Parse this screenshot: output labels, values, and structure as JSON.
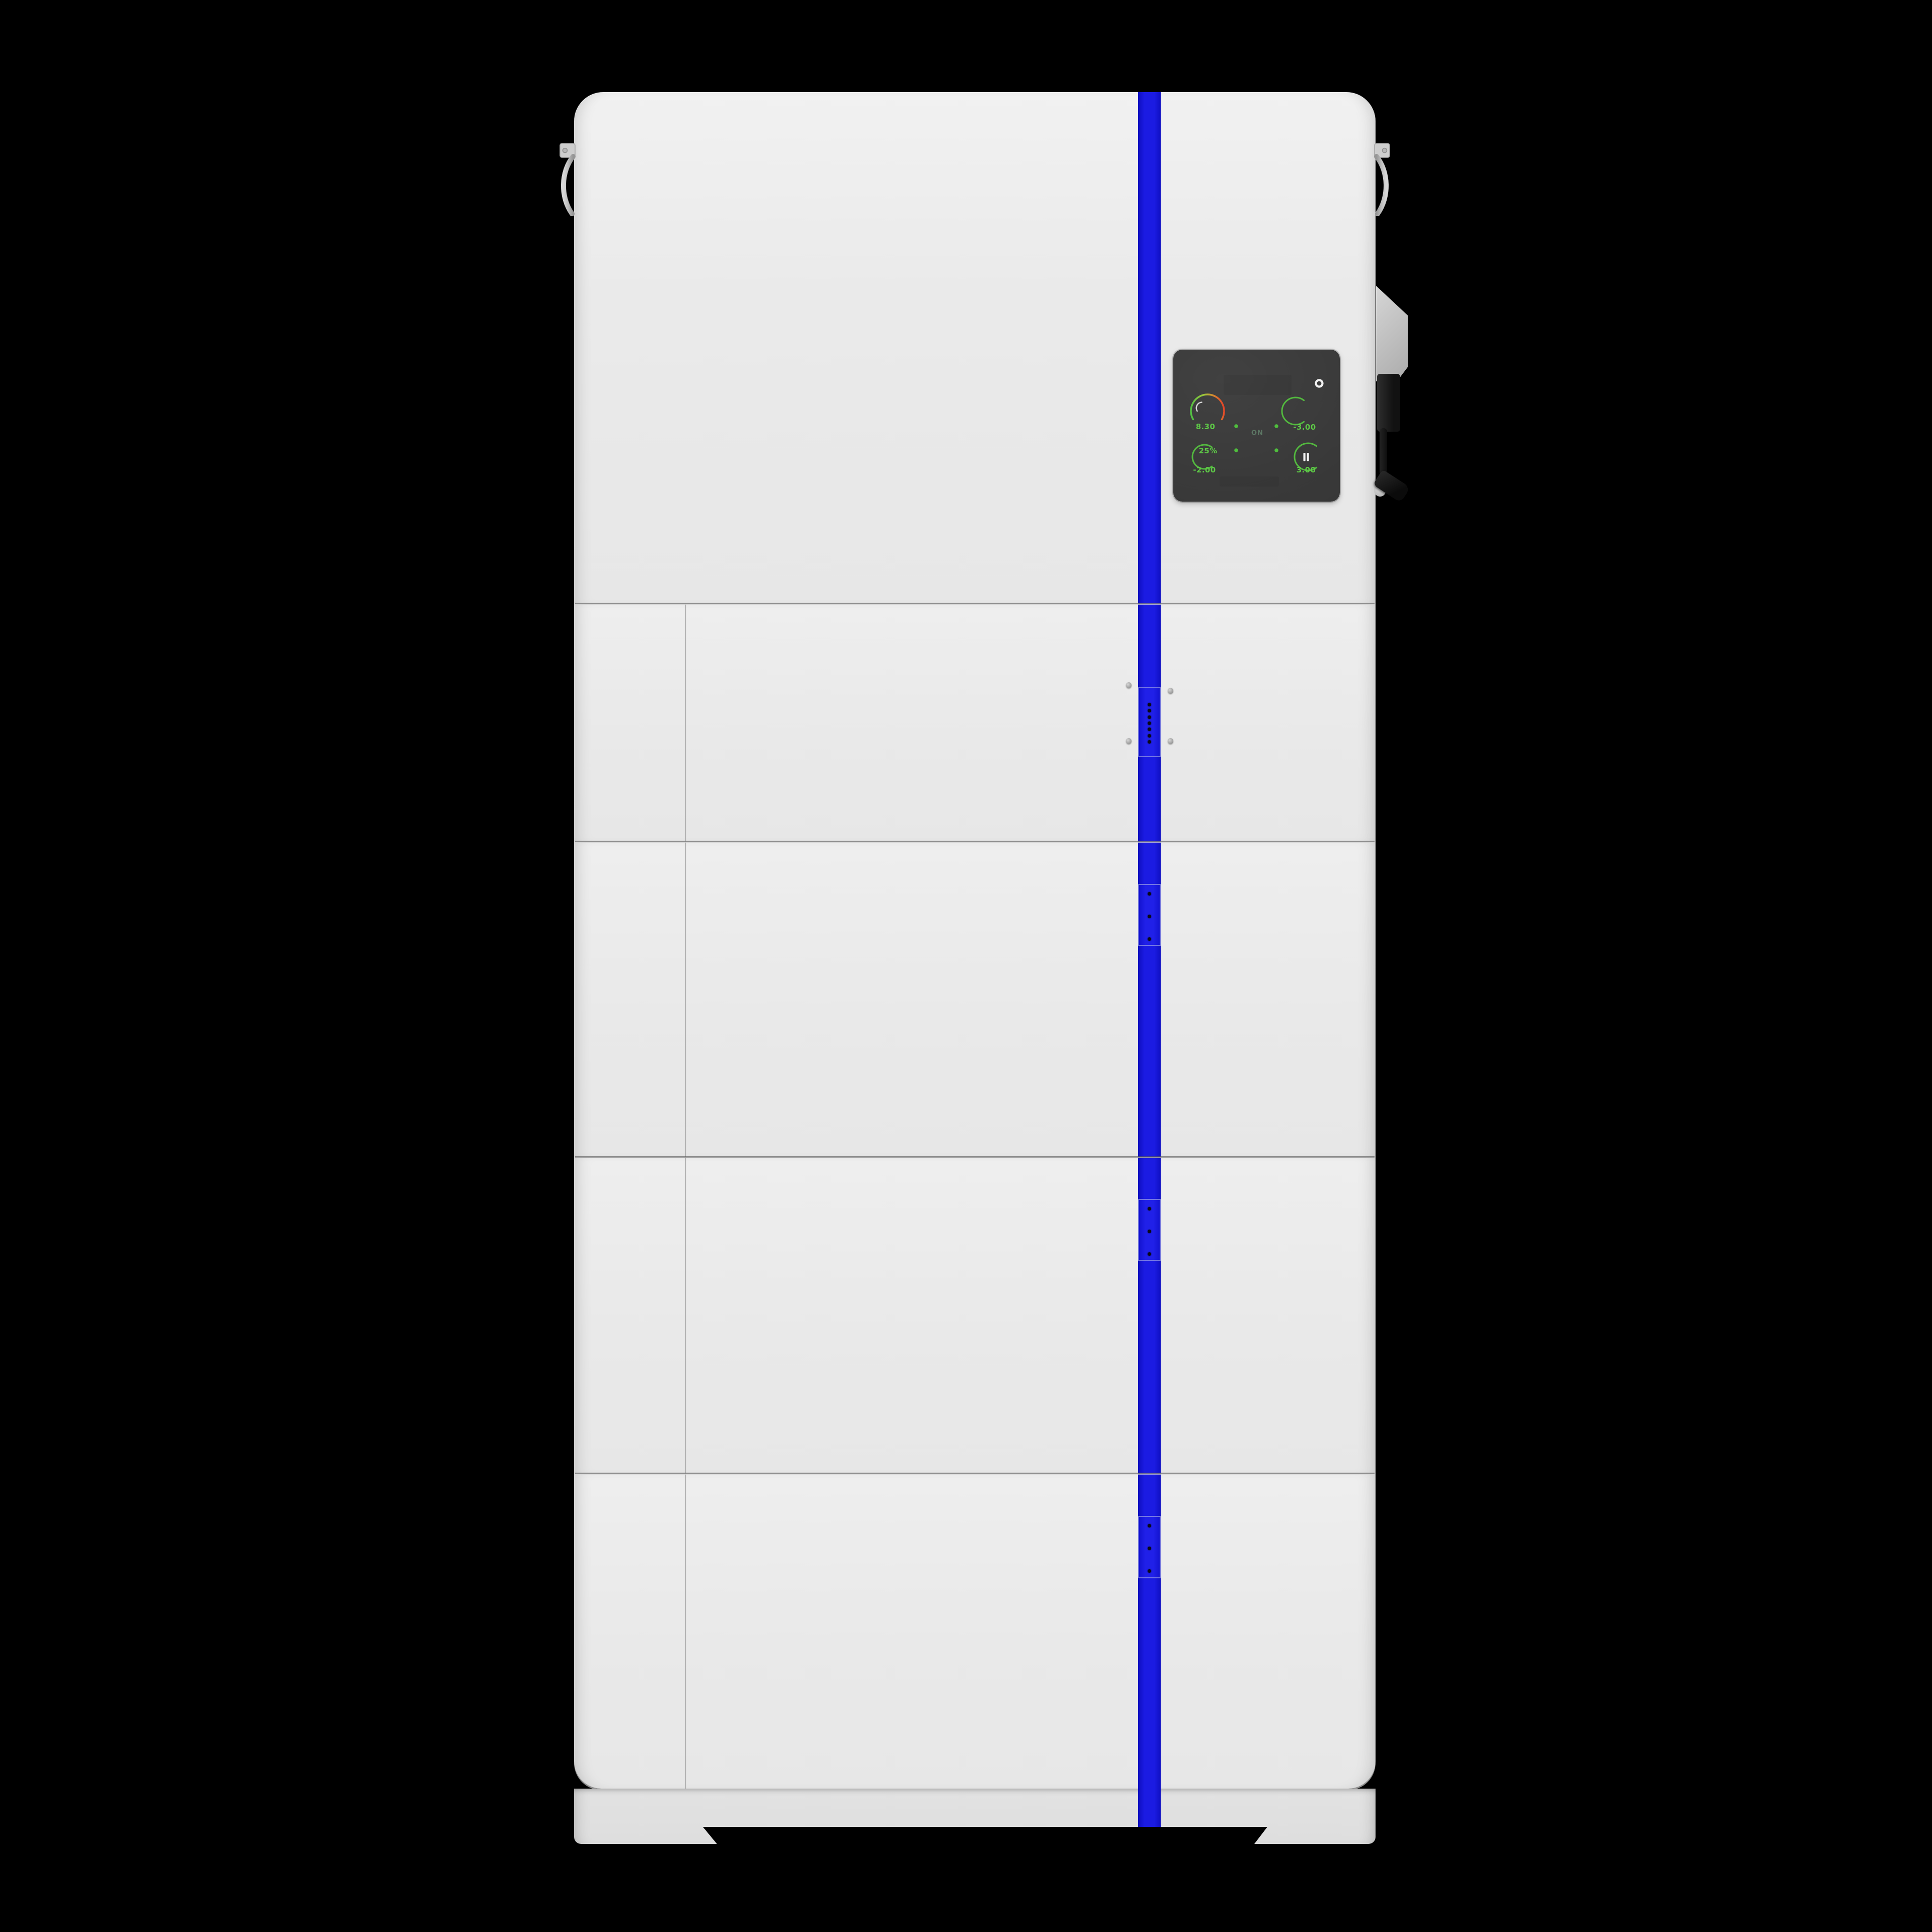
{
  "scene": {
    "background_color": "#000000",
    "device_label": "stacked energy storage system"
  },
  "device": {
    "body_color": "#e9e9e9",
    "accent_stripe_color": "#1b1be2",
    "display": {
      "background_color": "#3a3a3a",
      "status_text": "ON",
      "power_indicator_icon": "power-ring-icon",
      "pause_icon": "pause-icon",
      "accent_green": "#5ec947",
      "gauge_gradient": [
        "#53c043",
        "#9cc73c",
        "#e34028"
      ],
      "flow_dot_count": 4,
      "metrics": {
        "top_left_value": "8.30",
        "top_right_value": "-3.00",
        "bottom_left_percent": "25%",
        "bottom_left_value": "-2.00",
        "bottom_right_value": "3.00"
      }
    },
    "battery_modules": [
      {
        "label": "battery-module-1",
        "led_count": 7
      },
      {
        "label": "battery-module-2",
        "led_count": 3
      },
      {
        "label": "battery-module-3",
        "led_count": 3
      },
      {
        "label": "battery-module-4",
        "led_count": 3
      }
    ]
  }
}
